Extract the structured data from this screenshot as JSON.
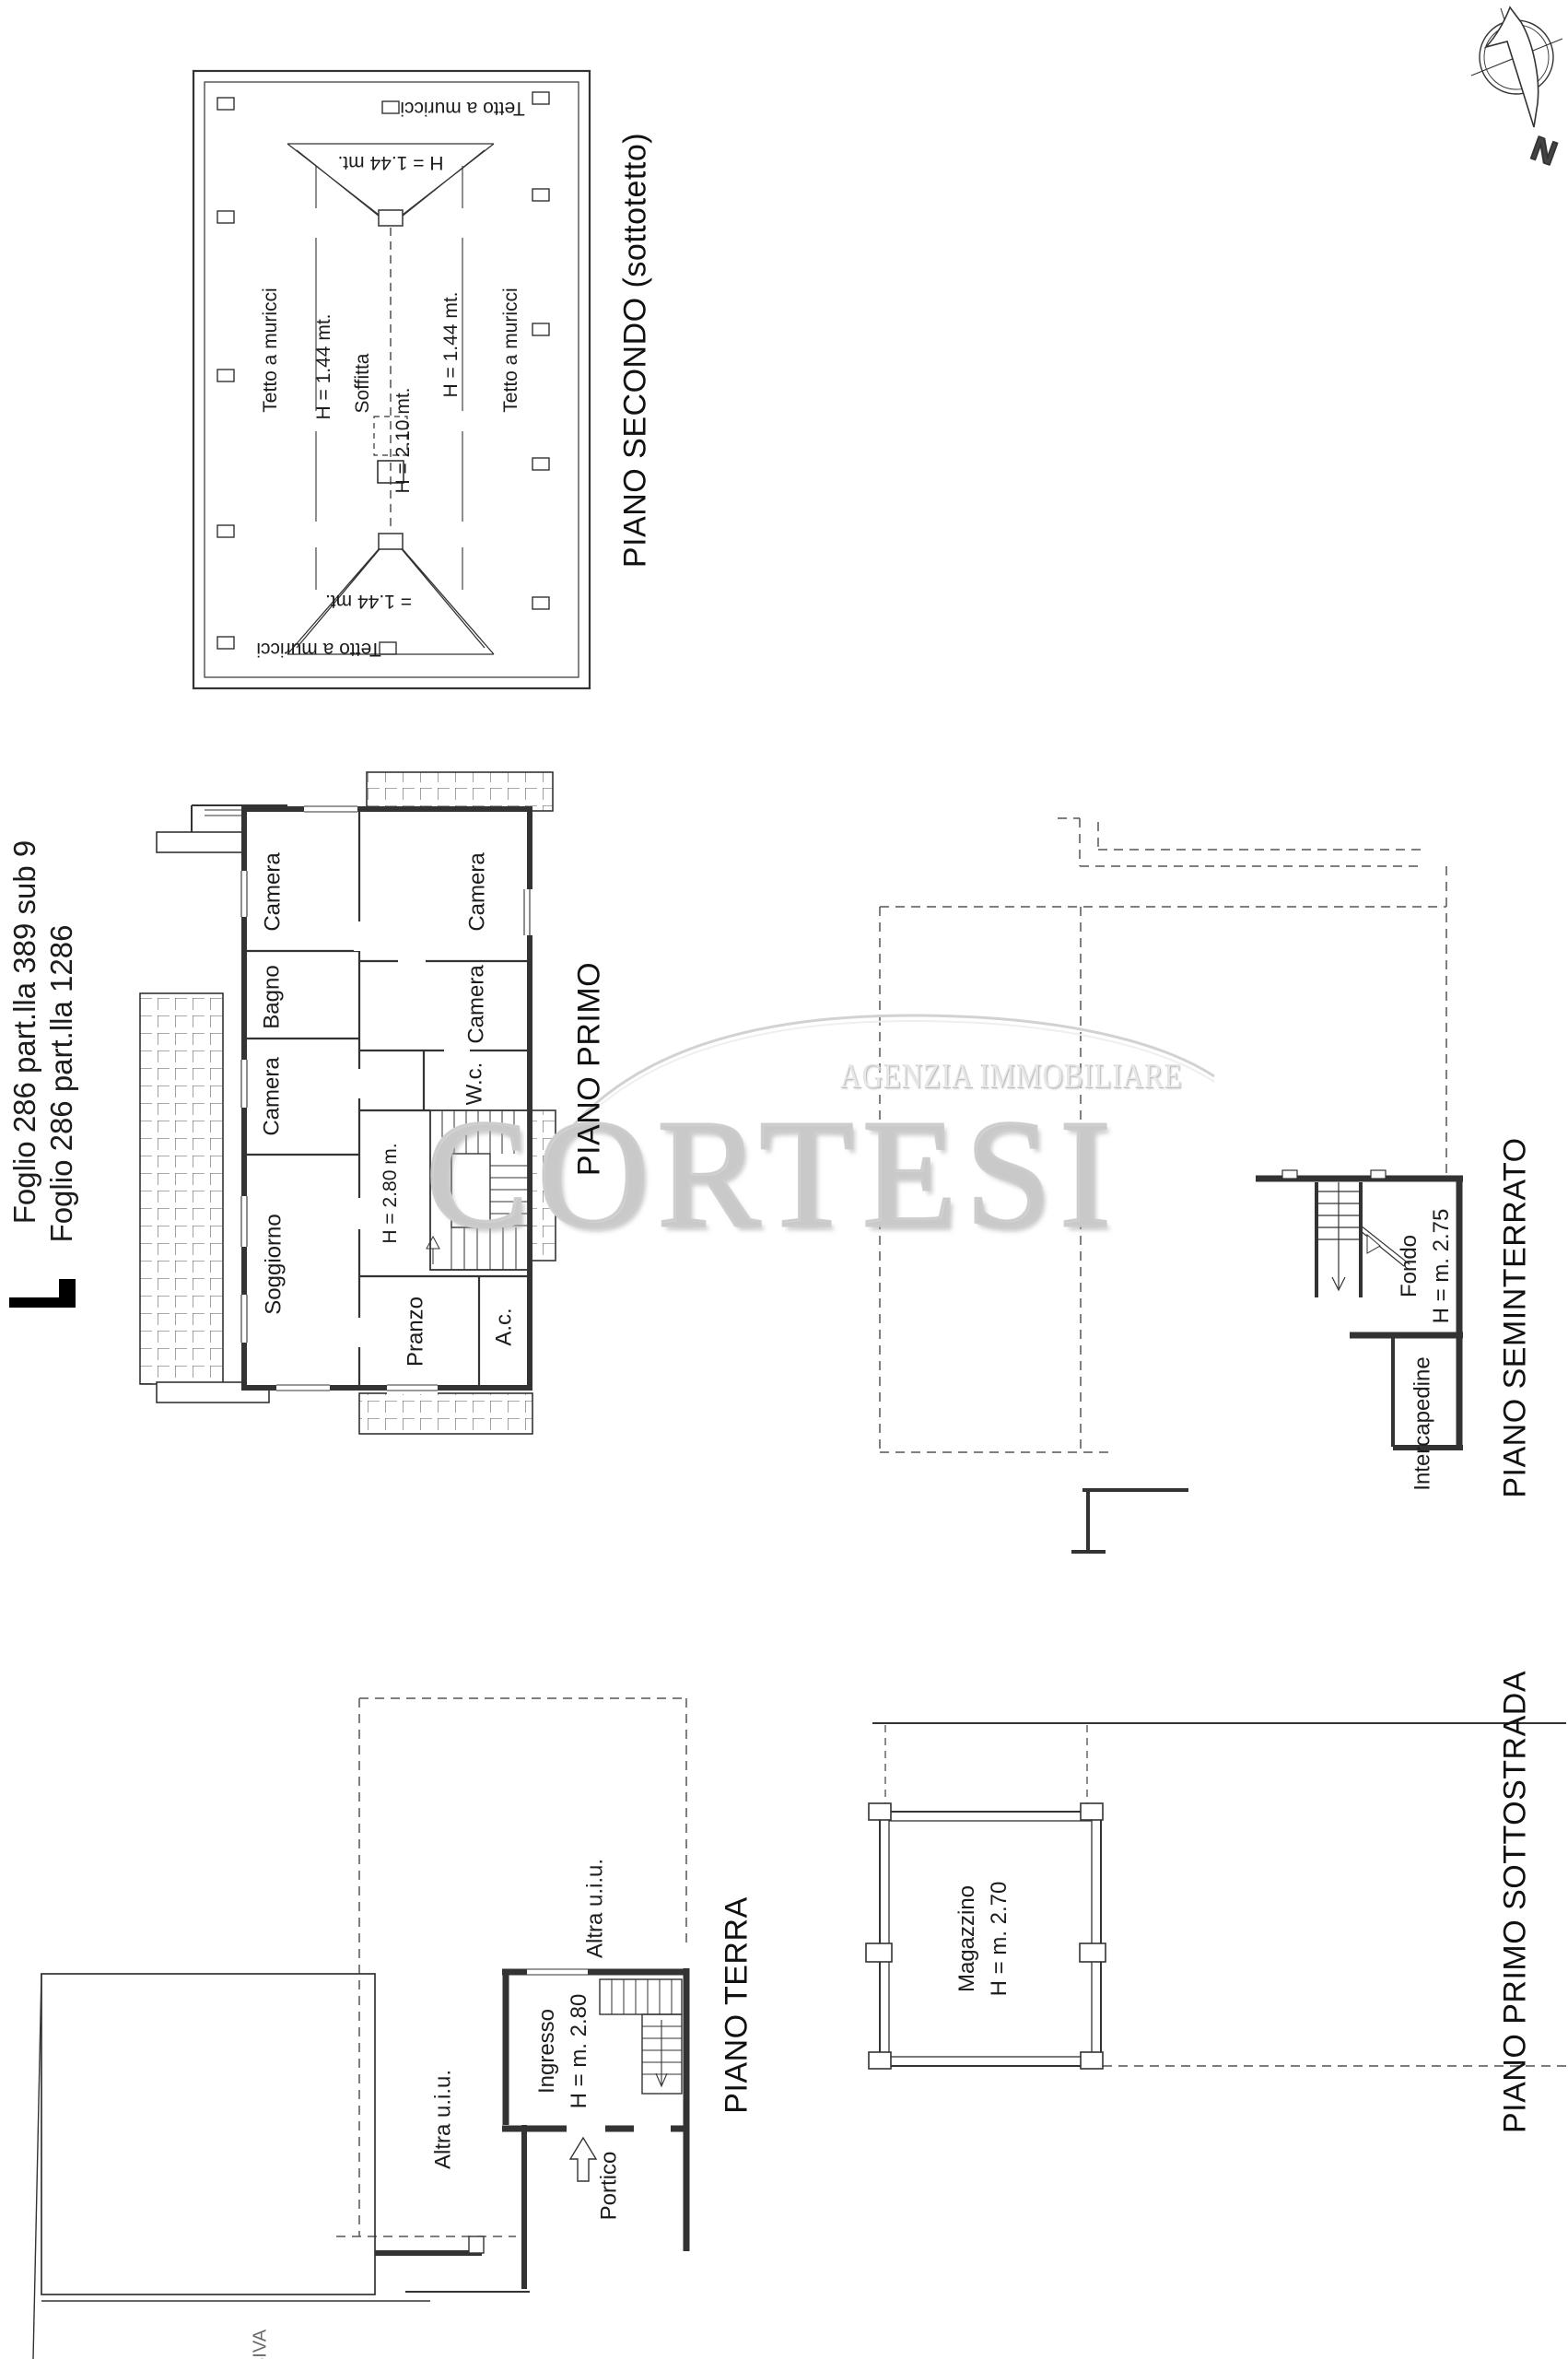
{
  "document": {
    "cadastral_line1": "Foglio 286 part.lla 389 sub 9",
    "cadastral_line2": "Foglio 286 part.lla 1286",
    "bottom_partial_text": "SIVA"
  },
  "compass": {
    "north_label": "N"
  },
  "watermark": {
    "line1": "AGENZIA IMMOBILIARE",
    "line2": "CORTESI"
  },
  "plan_secondo": {
    "title": "PIANO SECONDO (sottotetto)",
    "tetto_left": "Tetto a muricci",
    "tetto_right": "Tetto a muricci",
    "tetto_top": "Tetto a muricci",
    "tetto_bottom": "Tetto a muricci",
    "h_left": "H = 1.44 mt.",
    "h_right": "H = 1.44 mt.",
    "h_gable_top": "H = 1.44 mt.",
    "h_gable_bottom": "= 1.44 mt.",
    "soffitta": "Soffitta",
    "h_ridge": "H = 2.10 mt."
  },
  "plan_primo": {
    "title": "PIANO PRIMO",
    "camera_top_left": "Camera",
    "bagno": "Bagno",
    "camera_mid_left": "Camera",
    "soggiorno": "Soggiorno",
    "camera_top_right": "Camera",
    "camera_mid_right": "Camera",
    "wc": "W.c.",
    "pranzo": "Pranzo",
    "ac": "A.c.",
    "height_label": "H = 2.80 m."
  },
  "plan_seminterrato": {
    "title": "PIANO SEMINTERRATO",
    "fondo": "Fondo",
    "fondo_height": "H = m. 2.75",
    "intercapedine": "Intercapedine"
  },
  "plan_terra": {
    "title": "PIANO TERRA",
    "ingresso": "Ingresso",
    "ingresso_height": "H = m. 2.80",
    "portico": "Portico",
    "altra_uiu_top": "Altra u.i.u.",
    "altra_uiu_left": "Altra u.i.u."
  },
  "plan_sottostrada": {
    "title": "PIANO PRIMO SOTTOSTRADA",
    "magazzino": "Magazzino",
    "magazzino_height": "H = m. 2.70"
  }
}
